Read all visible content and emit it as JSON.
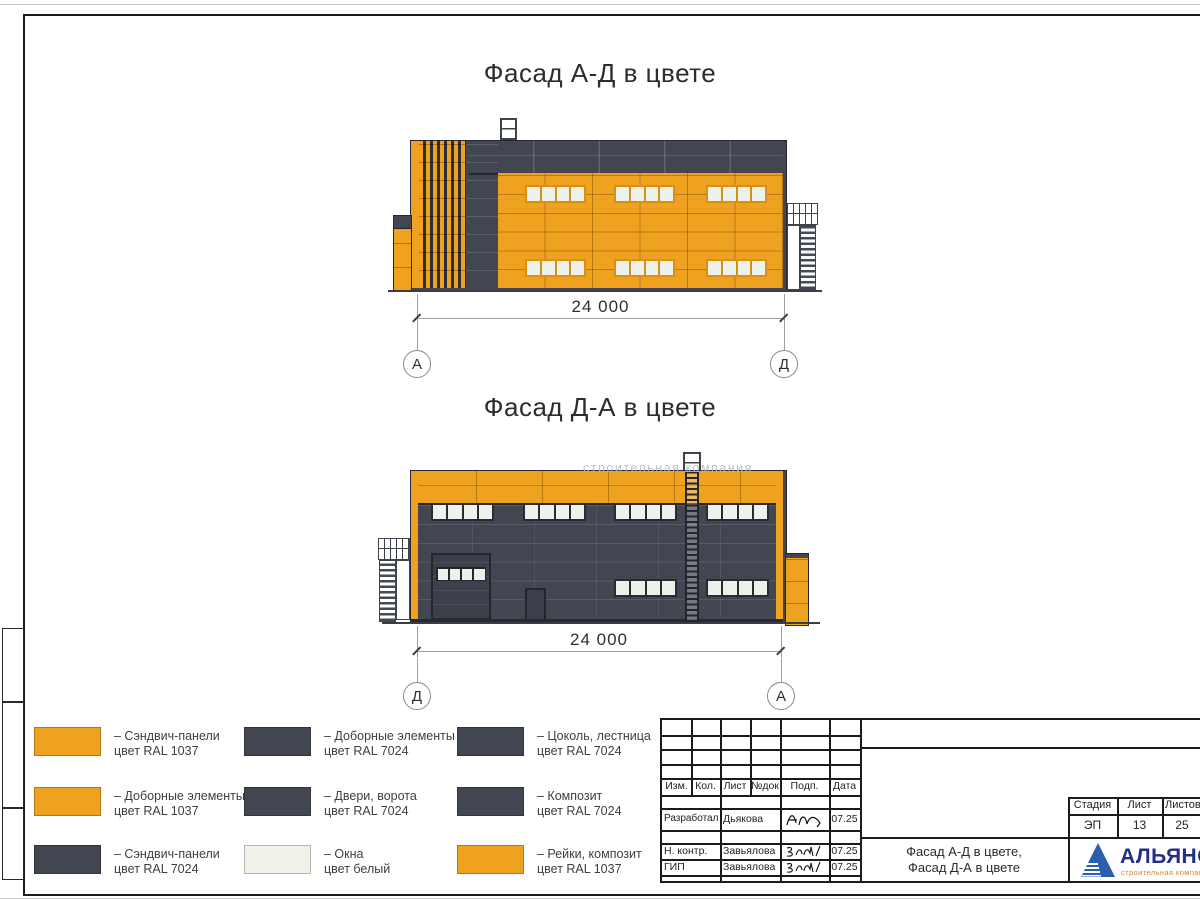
{
  "page": {
    "titles": {
      "facade1": "Фасад А-Д в цвете",
      "facade2": "Фасад Д-А в цвете"
    },
    "dimensions": {
      "facade1": "24 000",
      "facade2": "24 000"
    },
    "axes": {
      "facade1": {
        "left": "А",
        "right": "Д"
      },
      "facade2": {
        "left": "Д",
        "right": "А"
      }
    },
    "watermark": "строительная компания"
  },
  "legend": {
    "items": [
      {
        "color": "#EFA21F",
        "line1": "– Сэндвич-панели",
        "line2": "цвет RAL 1037"
      },
      {
        "color": "#EFA21F",
        "line1": "– Доборные элементы",
        "line2": "цвет RAL 1037"
      },
      {
        "color": "#424651",
        "line1": "– Сэндвич-панели",
        "line2": "цвет RAL 7024"
      },
      {
        "color": "#424651",
        "line1": "– Доборные элементы",
        "line2": "цвет RAL 7024"
      },
      {
        "color": "#424651",
        "line1": "– Двери, ворота",
        "line2": "цвет RAL 7024"
      },
      {
        "color": "#EFF2E9",
        "line1": "– Окна",
        "line2": "цвет белый"
      },
      {
        "color": "#424651",
        "line1": "– Цоколь, лестница",
        "line2": "цвет RAL 7024"
      },
      {
        "color": "#424651",
        "line1": "– Композит",
        "line2": "цвет RAL 7024"
      },
      {
        "color": "#EFA21F",
        "line1": "– Рейки, композит",
        "line2": "цвет RAL 1037"
      }
    ]
  },
  "titleblock": {
    "headers": {
      "izm": "Изм.",
      "kol": "Кол.",
      "list": "Лист",
      "ndok": "№док",
      "podp": "Подп.",
      "date": "Дата"
    },
    "rows": [
      {
        "role": "Разработал",
        "name": "Дьякова",
        "date": "07.25"
      },
      {
        "role": "Н. контр.",
        "name": "Завьялова",
        "date": "07.25"
      },
      {
        "role": "ГИП",
        "name": "Завьялова",
        "date": "07.25"
      }
    ],
    "stage": {
      "label_stage": "Стадия",
      "label_sheet": "Лист",
      "label_sheets": "Листов",
      "stage": "ЭП",
      "sheet": "13",
      "sheets": "25"
    },
    "doc_title_line1": "Фасад А-Д в цвете,",
    "doc_title_line2": "Фасад Д-А в цвете",
    "logo": {
      "name": "АЛЬЯНС",
      "subtitle": "строительная компания"
    }
  },
  "colors": {
    "orange_ral1037": "#EFA21F",
    "gray_ral7024": "#424651",
    "window_white": "#EFF2E9",
    "logo_blue": "#232E86",
    "logo_orange": "#D4862C"
  }
}
